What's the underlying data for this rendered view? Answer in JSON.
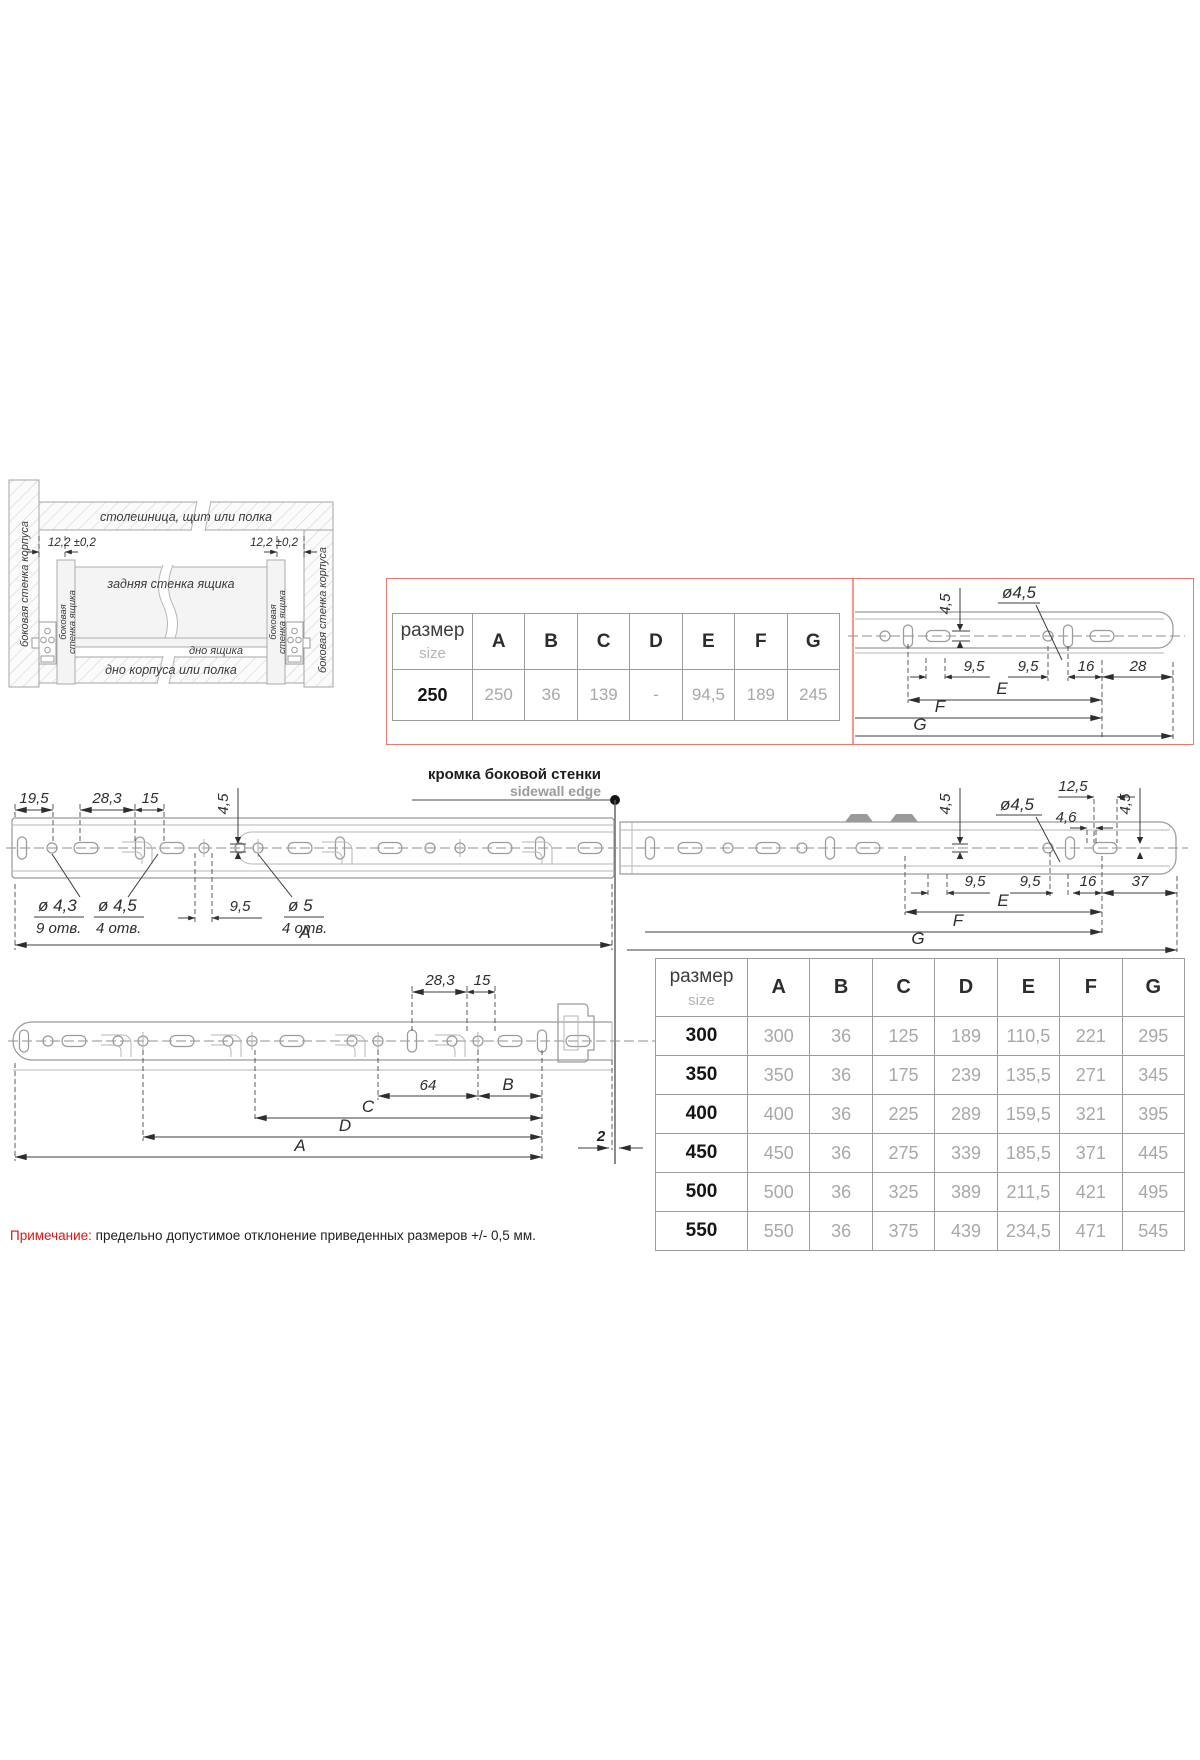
{
  "colors": {
    "red_box_border": "#f4766b",
    "note_red": "#e21313",
    "dim_text": "#2d2d2d",
    "value_gray": "#a8a8a8",
    "line_gray": "#9b9b9b"
  },
  "cabinet": {
    "top_panel": "столешница, щит или полка",
    "side_wall_left": "боковая стенка корпуса",
    "side_wall_right": "боковая стенка корпуса",
    "offset_left": "12,2 ±0,2",
    "offset_right": "12,2 ±0,2",
    "back_wall": "задняя стенка ящика",
    "drawer_side_line1": "боковая",
    "drawer_side_line2": "стенка ящика",
    "drawer_bottom": "дно ящика",
    "bottom_panel": "дно корпуса или полка"
  },
  "sidewall_edge": {
    "ru": "кромка боковой стенки",
    "en": "sidewall edge"
  },
  "dims": {
    "d45": "4,5",
    "dia45": "ø4,5",
    "d95": "9,5",
    "d16": "16",
    "d28": "28",
    "d195": "19,5",
    "d283": "28,3",
    "d15": "15",
    "d125": "12,5",
    "d46": "4,6",
    "d37": "37",
    "dia43": "ø 4,3",
    "dia45s": "ø 4,5",
    "dia5": "ø 5",
    "holes9": "9 отв.",
    "holes4": "4 отв.",
    "d64": "64",
    "d2": "2",
    "d122": "12,2",
    "A": "A",
    "B": "B",
    "C": "C",
    "D": "D",
    "E": "E",
    "F": "F",
    "G": "G"
  },
  "size_table_small": {
    "header_ru": "размер",
    "header_en": "size",
    "columns": [
      "A",
      "B",
      "C",
      "D",
      "E",
      "F",
      "G"
    ],
    "row_size": "250",
    "row_values": [
      "250",
      "36",
      "139",
      "-",
      "94,5",
      "189",
      "245"
    ]
  },
  "size_table": {
    "header_ru": "размер",
    "header_en": "size",
    "columns": [
      "A",
      "B",
      "C",
      "D",
      "E",
      "F",
      "G"
    ],
    "rows": [
      {
        "size": "300",
        "values": [
          "300",
          "36",
          "125",
          "189",
          "110,5",
          "221",
          "295"
        ]
      },
      {
        "size": "350",
        "values": [
          "350",
          "36",
          "175",
          "239",
          "135,5",
          "271",
          "345"
        ]
      },
      {
        "size": "400",
        "values": [
          "400",
          "36",
          "225",
          "289",
          "159,5",
          "321",
          "395"
        ]
      },
      {
        "size": "450",
        "values": [
          "450",
          "36",
          "275",
          "339",
          "185,5",
          "371",
          "445"
        ]
      },
      {
        "size": "500",
        "values": [
          "500",
          "36",
          "325",
          "389",
          "211,5",
          "421",
          "495"
        ]
      },
      {
        "size": "550",
        "values": [
          "550",
          "36",
          "375",
          "439",
          "234,5",
          "471",
          "545"
        ]
      }
    ]
  },
  "note": {
    "label": "Примечание:",
    "text": "предельно допустимое отклонение приведенных размеров +/- 0,5 мм."
  }
}
